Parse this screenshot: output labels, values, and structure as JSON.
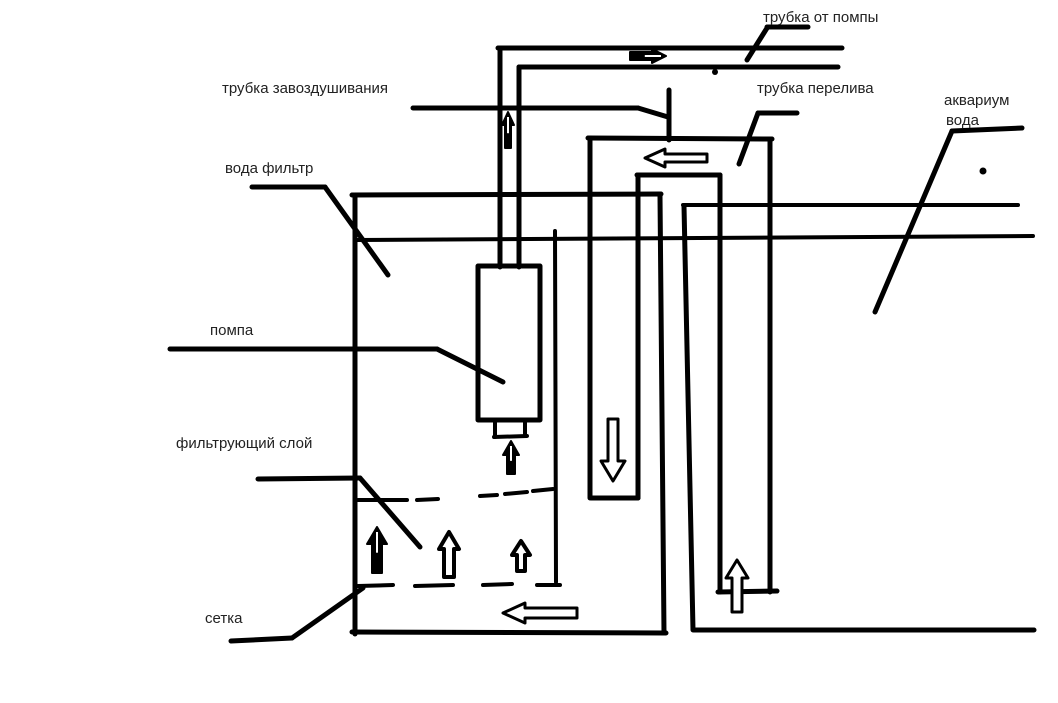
{
  "meta": {
    "title": "Hand-drawn aquarium sump filter scheme",
    "background": "#ffffff",
    "ink": "#000000",
    "label_color": "#222222",
    "label_font_size": 15,
    "default_stroke_width": 5
  },
  "labels": [
    {
      "id": "tube-from-pump",
      "text": "трубка от помпы",
      "x": 763,
      "y": 10
    },
    {
      "id": "air-vent-tube",
      "text": "трубка завоздушивания",
      "x": 222,
      "y": 81
    },
    {
      "id": "overflow-tube",
      "text": "трубка перелива",
      "x": 757,
      "y": 81
    },
    {
      "id": "aquarium",
      "text": "аквариум",
      "x": 944,
      "y": 93
    },
    {
      "id": "aquarium-water",
      "text": "вода",
      "x": 946,
      "y": 113
    },
    {
      "id": "filter-water",
      "text": "вода фильтр",
      "x": 225,
      "y": 161
    },
    {
      "id": "pump",
      "text": "помпа",
      "x": 210,
      "y": 323
    },
    {
      "id": "filter-layer",
      "text": "фильтрующий слой",
      "x": 176,
      "y": 436
    },
    {
      "id": "mesh",
      "text": "сетка",
      "x": 205,
      "y": 611
    }
  ],
  "strokes": [
    {
      "name": "filter-left-wall",
      "pts": [
        355,
        196,
        355,
        634
      ]
    },
    {
      "name": "filter-top-edge",
      "pts": [
        352,
        195,
        661,
        194
      ]
    },
    {
      "name": "filter-right-wall",
      "pts": [
        660,
        196,
        664,
        633
      ]
    },
    {
      "name": "filter-bottom-edge",
      "pts": [
        352,
        632,
        666,
        633
      ]
    },
    {
      "name": "water-level-line",
      "pts": [
        356,
        240,
        1033,
        236
      ],
      "w": 4
    },
    {
      "name": "pump-outlet-pipe-left",
      "pts": [
        500,
        48,
        500,
        267
      ]
    },
    {
      "name": "pump-outlet-pipe-right",
      "pts": [
        519,
        67,
        519,
        267
      ]
    },
    {
      "name": "top-pipe-upper",
      "pts": [
        498,
        48,
        842,
        48
      ]
    },
    {
      "name": "top-pipe-lower",
      "pts": [
        519,
        67,
        838,
        67
      ]
    },
    {
      "name": "overflow-outer-left",
      "pts": [
        590,
        139,
        590,
        498
      ]
    },
    {
      "name": "overflow-outer-top",
      "pts": [
        588,
        138,
        772,
        139
      ]
    },
    {
      "name": "overflow-outer-right",
      "pts": [
        770,
        139,
        770,
        592
      ]
    },
    {
      "name": "overflow-inner-left",
      "pts": [
        638,
        176,
        638,
        498
      ]
    },
    {
      "name": "overflow-inner-top",
      "pts": [
        637,
        175,
        720,
        175
      ]
    },
    {
      "name": "overflow-inner-right",
      "pts": [
        720,
        175,
        720,
        592
      ]
    },
    {
      "name": "overflow-left-leg-end",
      "pts": [
        591,
        498,
        638,
        498
      ]
    },
    {
      "name": "overflow-right-leg-end",
      "pts": [
        718,
        592,
        777,
        591
      ]
    },
    {
      "name": "air-vent-stub",
      "pts": [
        669,
        90,
        669,
        140
      ]
    },
    {
      "name": "pump-chamber-divider",
      "pts": [
        555,
        231,
        556,
        582
      ],
      "w": 4
    },
    {
      "name": "aquarium-left-wall",
      "pts": [
        684,
        206,
        693,
        630
      ]
    },
    {
      "name": "aquarium-top-edge",
      "pts": [
        683,
        205,
        1018,
        205
      ],
      "w": 4
    },
    {
      "name": "aquarium-bottom-edge",
      "pts": [
        694,
        630,
        1034,
        630
      ]
    },
    {
      "name": "pump-nozzle-left",
      "pts": [
        495,
        420,
        495,
        437
      ],
      "w": 4
    },
    {
      "name": "pump-nozzle-right",
      "pts": [
        525,
        420,
        525,
        436
      ],
      "w": 4
    },
    {
      "name": "pump-nozzle-bottom",
      "pts": [
        494,
        437,
        527,
        436
      ],
      "w": 4
    },
    {
      "name": "leader-pump-h",
      "pts": [
        170,
        349,
        437,
        349
      ]
    },
    {
      "name": "leader-pump-d",
      "pts": [
        437,
        349,
        503,
        382
      ]
    },
    {
      "name": "leader-filter-water-h",
      "pts": [
        252,
        187,
        325,
        187
      ]
    },
    {
      "name": "leader-filter-water-d",
      "pts": [
        325,
        187,
        388,
        275
      ]
    },
    {
      "name": "leader-air-vent-h",
      "pts": [
        413,
        108,
        638,
        108
      ]
    },
    {
      "name": "leader-air-vent-d",
      "pts": [
        638,
        108,
        668,
        117
      ]
    },
    {
      "name": "leader-overflow-h",
      "pts": [
        758,
        113,
        797,
        113
      ]
    },
    {
      "name": "leader-overflow-d",
      "pts": [
        758,
        113,
        739,
        164
      ]
    },
    {
      "name": "leader-from-pump-h",
      "pts": [
        767,
        27,
        808,
        27
      ]
    },
    {
      "name": "leader-from-pump-d",
      "pts": [
        767,
        28,
        747,
        60
      ]
    },
    {
      "name": "leader-aquarium-h",
      "pts": [
        952,
        131,
        1022,
        128
      ]
    },
    {
      "name": "leader-aquarium-d",
      "pts": [
        952,
        131,
        875,
        312
      ]
    },
    {
      "name": "leader-mesh-h",
      "pts": [
        231,
        641,
        292,
        638
      ]
    },
    {
      "name": "leader-mesh-d",
      "pts": [
        292,
        638,
        363,
        588
      ]
    },
    {
      "name": "leader-layer-h",
      "pts": [
        258,
        479,
        360,
        478
      ]
    },
    {
      "name": "leader-layer-d",
      "pts": [
        360,
        478,
        420,
        547
      ]
    },
    {
      "name": "layer-dash-top-1",
      "pts": [
        358,
        500,
        407,
        500
      ],
      "w": 4
    },
    {
      "name": "layer-dash-top-2",
      "pts": [
        417,
        500,
        438,
        499
      ],
      "w": 4
    },
    {
      "name": "layer-dash-top-3",
      "pts": [
        480,
        496,
        497,
        495
      ],
      "w": 4
    },
    {
      "name": "layer-dash-top-4",
      "pts": [
        505,
        494,
        527,
        492
      ],
      "w": 4
    },
    {
      "name": "layer-dash-top-5",
      "pts": [
        533,
        491,
        553,
        489
      ],
      "w": 4
    },
    {
      "name": "layer-dash-bottom-1",
      "pts": [
        358,
        586,
        393,
        585
      ],
      "w": 4
    },
    {
      "name": "layer-dash-bottom-2",
      "pts": [
        415,
        586,
        453,
        585
      ],
      "w": 4
    },
    {
      "name": "layer-dash-bottom-3",
      "pts": [
        483,
        585,
        512,
        584
      ],
      "w": 4
    },
    {
      "name": "layer-dash-bottom-4",
      "pts": [
        537,
        585,
        560,
        585
      ],
      "w": 4
    }
  ],
  "rects": [
    {
      "name": "pump-body",
      "x": 478,
      "y": 266,
      "w": 62,
      "h": 154,
      "stroke_w": 5
    }
  ],
  "arrows": [
    {
      "name": "flow-right-top-pipe",
      "dir": "right",
      "tip": [
        666,
        56
      ],
      "len": 36,
      "head_len": 14,
      "head_hw": 7,
      "shaft_hw": 4,
      "style": "filled",
      "slit": true
    },
    {
      "name": "flow-up-pump-outlet-pipe",
      "dir": "up",
      "tip": [
        508,
        112
      ],
      "len": 36,
      "head_len": 13,
      "head_hw": 6,
      "shaft_hw": 3,
      "style": "filled",
      "slit": true
    },
    {
      "name": "flow-left-overflow-top",
      "dir": "left",
      "tip": [
        645,
        158
      ],
      "len": 62,
      "head_len": 20,
      "head_hw": 9,
      "shaft_hw": 4,
      "style": "hollow",
      "stroke_w": 3
    },
    {
      "name": "flow-down-overflow-left-leg",
      "dir": "down",
      "tip": [
        613,
        481
      ],
      "len": 62,
      "head_len": 20,
      "head_hw": 12,
      "shaft_hw": 5,
      "style": "hollow",
      "stroke_w": 3
    },
    {
      "name": "flow-up-overflow-right-leg",
      "dir": "up",
      "tip": [
        737,
        560
      ],
      "len": 52,
      "head_len": 18,
      "head_hw": 11,
      "shaft_hw": 5,
      "style": "hollow",
      "stroke_w": 3
    },
    {
      "name": "flow-up-pump-inlet",
      "dir": "up",
      "tip": [
        511,
        441
      ],
      "len": 33,
      "head_len": 14,
      "head_hw": 8,
      "shaft_hw": 4,
      "style": "filled",
      "slit": true
    },
    {
      "name": "flow-up-filter-layer-1",
      "dir": "up",
      "tip": [
        377,
        527
      ],
      "len": 46,
      "head_len": 17,
      "head_hw": 10,
      "shaft_hw": 5,
      "style": "filled",
      "slit": true
    },
    {
      "name": "flow-up-filter-layer-2",
      "dir": "up",
      "tip": [
        449,
        532
      ],
      "len": 45,
      "head_len": 17,
      "head_hw": 10,
      "shaft_hw": 5,
      "style": "hollow",
      "stroke_w": 4
    },
    {
      "name": "flow-up-filter-layer-3",
      "dir": "up",
      "tip": [
        521,
        541
      ],
      "len": 30,
      "head_len": 14,
      "head_hw": 9,
      "shaft_hw": 4,
      "style": "hollow",
      "stroke_w": 4
    },
    {
      "name": "flow-left-filter-bottom",
      "dir": "left",
      "tip": [
        503,
        613
      ],
      "len": 74,
      "head_len": 22,
      "head_hw": 10,
      "shaft_hw": 5,
      "style": "hollow",
      "stroke_w": 3
    }
  ],
  "dots": [
    {
      "name": "ink-dot-top-pipe",
      "x": 715,
      "y": 72,
      "r": 3
    },
    {
      "name": "ink-dot-aquarium",
      "x": 983,
      "y": 171,
      "r": 3.5
    }
  ]
}
